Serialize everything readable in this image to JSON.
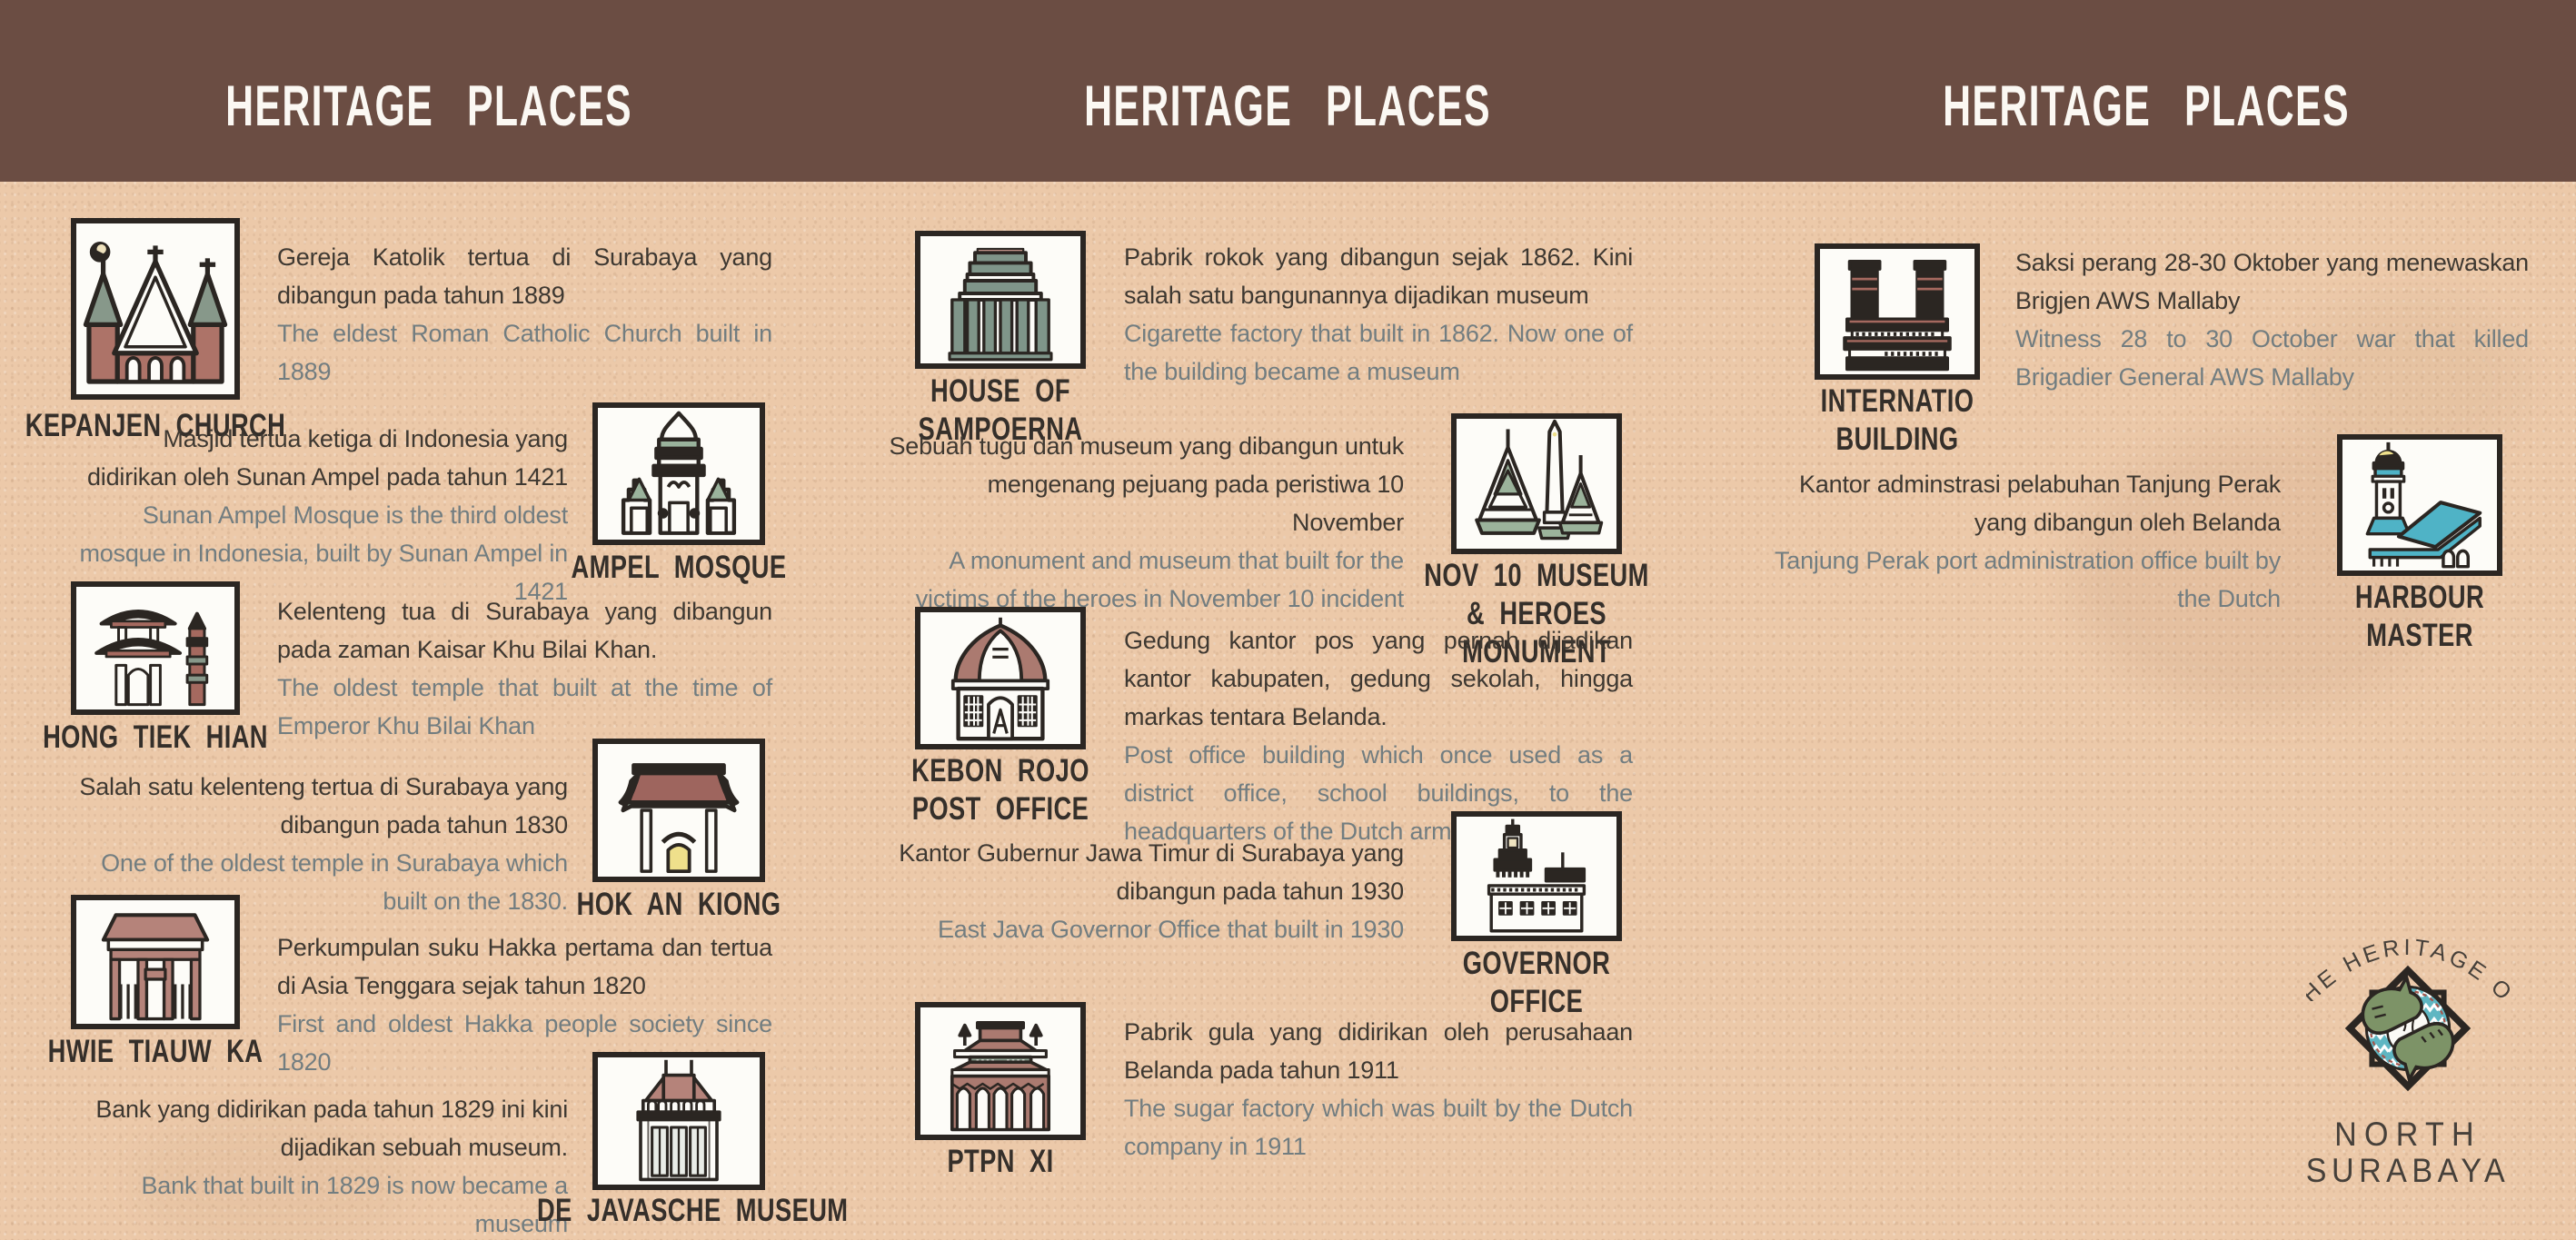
{
  "colors": {
    "background": "#ecc9a9",
    "band": "#6b4d43",
    "header_text": "#fbf8f3",
    "text_dark": "#3e3831",
    "text_gray": "#727d80",
    "label": "#352f2a",
    "icon_outline": "#2b2622",
    "sage_green": "#9ab39c",
    "column_green": "#7f9589",
    "brick_red": "#ad7368",
    "dark_red": "#a5695f",
    "teal": "#4fb3c6",
    "lamp_yellow": "#f0e48a"
  },
  "headers": {
    "left": "HERITAGE PLACES",
    "center": "HERITAGE PLACES",
    "right": "HERITAGE PLACES"
  },
  "entries": {
    "kepanjen": {
      "label": "KEPANJEN CHURCH",
      "icon": "kepanjen-church-icon",
      "desc_id": "Gereja Katolik tertua di Surabaya yang dibangun pada tahun 1889",
      "desc_en": "The eldest Roman Catholic Church built in 1889"
    },
    "ampel": {
      "label": "AMPEL MOSQUE",
      "icon": "ampel-mosque-icon",
      "desc_id": "Masjid tertua ketiga di Indonesia yang didirikan oleh Sunan Ampel pada tahun 1421",
      "desc_en": "Sunan Ampel Mosque is the third oldest mosque in Indonesia, built by Sunan Ampel in 1421"
    },
    "hongtiekhian": {
      "label": "HONG TIEK HIAN",
      "icon": "hong-tiek-hian-icon",
      "desc_id": "Kelenteng tua di Surabaya yang dibangun pada zaman Kaisar Khu Bilai Khan.",
      "desc_en": "The oldest temple that built at the time of Emperor Khu Bilai Khan"
    },
    "hokankiong": {
      "label": "HOK AN KIONG",
      "icon": "hok-an-kiong-icon",
      "desc_id": "Salah satu kelenteng tertua di Surabaya yang dibangun pada tahun 1830",
      "desc_en": "One of the oldest temple in Surabaya which built on the 1830."
    },
    "hwietiauwka": {
      "label": "HWIE TIAUW KA",
      "icon": "hwie-tiauw-ka-icon",
      "desc_id": "Perkumpulan suku Hakka pertama dan tertua di Asia Tenggara sejak tahun 1820",
      "desc_en": "First and oldest Hakka people society since 1820"
    },
    "javasche": {
      "label": "DE JAVASCHE MUSEUM",
      "icon": "de-javasche-museum-icon",
      "desc_id": "Bank yang didirikan pada tahun 1829 ini kini dijadikan sebuah museum.",
      "desc_en": "Bank that built in 1829 is now became a museum"
    },
    "sampoerna": {
      "label": "HOUSE OF SAMPOERNA",
      "icon": "house-of-sampoerna-icon",
      "desc_id": "Pabrik rokok yang dibangun sejak 1862. Kini salah satu bangunannya dijadikan museum",
      "desc_en": "Cigarette factory that built in 1862. Now one of the building became a museum"
    },
    "nov10": {
      "label": "NOV 10 MUSEUM & HEROES MONUMENT",
      "icon": "nov-10-museum-icon",
      "desc_id": "Sebuah tugu dan museum yang dibangun untuk mengenang pejuang pada peristiwa 10 November",
      "desc_en": "A monument and museum that built for the victims of the heroes in November 10 incident"
    },
    "kebonrojo": {
      "label": "KEBON ROJO POST OFFICE",
      "icon": "kebon-rojo-post-office-icon",
      "desc_id": "Gedung kantor pos yang pernah dijadikan kantor kabupaten, gedung sekolah, hingga markas tentara Belanda.",
      "desc_en": "Post office building which once used as a district office, school buildings, to the headquarters of the Dutch army."
    },
    "governor": {
      "label": "GOVERNOR OFFICE",
      "icon": "governor-office-icon",
      "desc_id": "Kantor Gubernur Jawa Timur di Surabaya yang dibangun pada tahun 1930",
      "desc_en": "East Java Governor Office that built in 1930"
    },
    "ptpn": {
      "label": "PTPN XI",
      "icon": "ptpn-xi-icon",
      "desc_id": "Pabrik gula yang didirikan oleh perusahaan Belanda pada tahun 1911",
      "desc_en": "The sugar factory which was built by the Dutch company in 1911"
    },
    "internatio": {
      "label": "INTERNATIO BUILDING",
      "icon": "internatio-building-icon",
      "desc_id": "Saksi perang 28-30 Oktober yang menewaskan Brigjen AWS Mallaby",
      "desc_en": "Witness 28 to 30 October war that killed Brigadier General AWS Mallaby"
    },
    "harbour": {
      "label": "HARBOUR MASTER",
      "icon": "harbour-master-icon",
      "desc_id": "Kantor adminstrasi pelabuhan Tanjung Perak yang dibangun oleh Belanda",
      "desc_en": "Tanjung Perak port administration office built by the Dutch"
    }
  },
  "logo": {
    "arc": "THE HERITAGE OF",
    "line1": "NORTH",
    "line2": "SURABAYA"
  }
}
